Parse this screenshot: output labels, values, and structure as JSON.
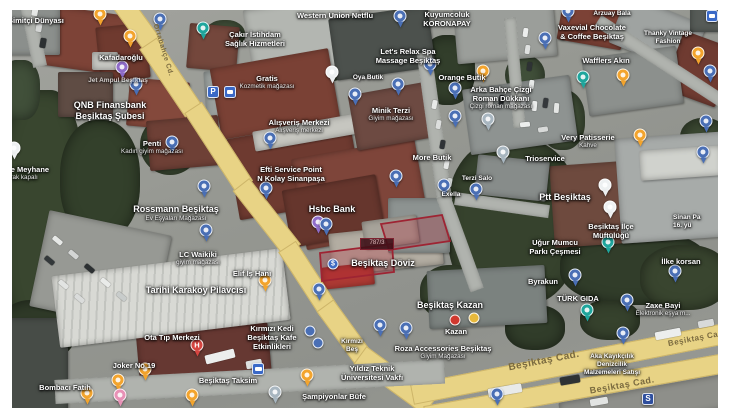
{
  "map": {
    "selected_parcel": {
      "badge": "787/3",
      "outline_color": "#9e2433",
      "fill_color": "rgba(178,34,52,0.28)"
    },
    "pin_colors": {
      "b": "#4a6fb5",
      "o": "#f3a42d",
      "t": "#1fa69d",
      "pu": "#8f6cc9",
      "h": "#d64540",
      "g": "#a8b6c0",
      "w": "#eef1f2",
      "pk": "#e891b6",
      "rc": "#d0382e",
      "yc": "#e8b93c",
      "bc": "#4a6fb5",
      "d": "#3f6bc4",
      "P": "#3a69c7",
      "S": "#2f4f9e",
      "BUS": "#3a69c7",
      "sq": "#3a69c7"
    },
    "road_labels": [
      {
        "text": "Ortabahçe Cd.",
        "x": 163,
        "y": 50,
        "rot": 73,
        "sz": 7
      },
      {
        "text": "Beşiktaş Cad.",
        "x": 697,
        "y": 338,
        "rot": -11,
        "sz": 8
      },
      {
        "text": "Beşiktaş Cad.",
        "x": 544,
        "y": 361,
        "rot": -11,
        "sz": 10
      },
      {
        "text": "Beşiktaş Cad.",
        "x": 622,
        "y": 385,
        "rot": -10,
        "sz": 9
      }
    ],
    "labels": [
      {
        "x": 8,
        "y": 16,
        "s": "m",
        "align": "l",
        "lines": [
          "Simitçi Dünyası"
        ]
      },
      {
        "x": 121,
        "y": 53,
        "s": "m",
        "lines": [
          "Kafadaroğlu"
        ]
      },
      {
        "x": 118,
        "y": 77,
        "s": "s",
        "dim": true,
        "lines": [
          "Jet Ampul Beşiktaş"
        ]
      },
      {
        "x": 110,
        "y": 100,
        "s": "l",
        "lines": [
          "QNB Finansbank",
          "Beşiktaş Şubesi"
        ]
      },
      {
        "x": 152,
        "y": 139,
        "s": "m",
        "lines": [
          "Penti"
        ],
        "sub": "Kadın giyim mağazası"
      },
      {
        "x": 2,
        "y": 165,
        "s": "m",
        "align": "l",
        "lines": [
          "ade Meyhane"
        ],
        "sub": "olarak kapalı"
      },
      {
        "x": 176,
        "y": 204,
        "s": "l",
        "lines": [
          "Rossmann Beşiktaş"
        ],
        "sub": "Ev Eşyaları Mağazası"
      },
      {
        "x": 198,
        "y": 250,
        "s": "m",
        "lines": [
          "LC Waikiki"
        ],
        "sub": "giyim mağazası"
      },
      {
        "x": 252,
        "y": 269,
        "s": "m",
        "lines": [
          "Elif İş Hanı"
        ]
      },
      {
        "x": 335,
        "y": 11,
        "s": "m",
        "lines": [
          "Western Union Netflu"
        ]
      },
      {
        "x": 447,
        "y": 10,
        "s": "m",
        "lines": [
          "Kuyumcoluk",
          "KORONAPAY"
        ]
      },
      {
        "x": 408,
        "y": 47,
        "s": "m",
        "lines": [
          "Let's Relax Spa",
          "Massage Beşiktaş"
        ]
      },
      {
        "x": 368,
        "y": 74,
        "s": "s",
        "lines": [
          "Oya Butik"
        ]
      },
      {
        "x": 462,
        "y": 73,
        "s": "m",
        "lines": [
          "Orange Butik"
        ]
      },
      {
        "x": 255,
        "y": 30,
        "s": "m",
        "lines": [
          "Çakır İstihdam",
          "Sağlık Hizmetleri"
        ]
      },
      {
        "x": 267,
        "y": 74,
        "s": "m",
        "lines": [
          "Gratis"
        ],
        "sub": "Kozmetik mağazası"
      },
      {
        "x": 299,
        "y": 118,
        "s": "m",
        "lines": [
          "Alışveriş Merkezi"
        ],
        "sub": "Alışveriş merkezi"
      },
      {
        "x": 391,
        "y": 106,
        "s": "m",
        "lines": [
          "Minik Terzi"
        ],
        "sub": "Giyim mağazası"
      },
      {
        "x": 291,
        "y": 165,
        "s": "m",
        "lines": [
          "Efti Service Point",
          "N Kolay Sinanpaşa"
        ]
      },
      {
        "x": 332,
        "y": 204,
        "s": "l",
        "lines": [
          "Hsbc Bank"
        ]
      },
      {
        "x": 432,
        "y": 153,
        "s": "m",
        "lines": [
          "More Butik"
        ]
      },
      {
        "x": 451,
        "y": 191,
        "s": "s",
        "lines": [
          "Exella"
        ]
      },
      {
        "x": 477,
        "y": 175,
        "s": "s",
        "lines": [
          "Terzi Salo"
        ]
      },
      {
        "x": 501,
        "y": 85,
        "s": "m",
        "lines": [
          "Arka Bahçe Çizgi",
          "Roman Dükkanı"
        ],
        "sub": "Çizgi roman mağazası"
      },
      {
        "x": 612,
        "y": 10,
        "s": "s",
        "lines": [
          "Arzuay Bala"
        ]
      },
      {
        "x": 592,
        "y": 23,
        "s": "m",
        "lines": [
          "Vaxevial Chocolate",
          "& Coffee Beşiktaş"
        ]
      },
      {
        "x": 668,
        "y": 30,
        "s": "s",
        "lines": [
          "Thanky Vintage",
          "Fashion"
        ]
      },
      {
        "x": 606,
        "y": 56,
        "s": "m",
        "lines": [
          "Wafflers Akın"
        ]
      },
      {
        "x": 588,
        "y": 133,
        "s": "m",
        "lines": [
          "Very Patisserie"
        ],
        "sub": "Kahve"
      },
      {
        "x": 545,
        "y": 154,
        "s": "m",
        "lines": [
          "Trioservice"
        ]
      },
      {
        "x": 565,
        "y": 192,
        "s": "l",
        "lines": [
          "Ptt Beşiktaş"
        ]
      },
      {
        "x": 611,
        "y": 222,
        "s": "m",
        "lines": [
          "Beşiktaş İlçe",
          "Müftülüğü"
        ]
      },
      {
        "x": 673,
        "y": 214,
        "s": "s",
        "align": "l",
        "lines": [
          "Sinan Pa",
          "16. yü"
        ]
      },
      {
        "x": 681,
        "y": 257,
        "s": "m",
        "lines": [
          "İlke korsan"
        ]
      },
      {
        "x": 555,
        "y": 238,
        "s": "m",
        "lines": [
          "Uğur Mumcu",
          "Parkı Çeşmesi"
        ]
      },
      {
        "x": 383,
        "y": 258,
        "s": "l",
        "lines": [
          "Beşiktaş Döviz"
        ]
      },
      {
        "x": 578,
        "y": 294,
        "s": "m",
        "lines": [
          "TÜRK GIDA"
        ]
      },
      {
        "x": 543,
        "y": 277,
        "s": "m",
        "lines": [
          "Byrakun"
        ]
      },
      {
        "x": 663,
        "y": 301,
        "s": "m",
        "lines": [
          "Zaxe Bayi"
        ],
        "sub": "Elektronik eşya m..."
      },
      {
        "x": 450,
        "y": 300,
        "s": "l",
        "lines": [
          "Beşiktaş Kazan"
        ]
      },
      {
        "x": 456,
        "y": 327,
        "s": "m",
        "lines": [
          "Kazan"
        ]
      },
      {
        "x": 443,
        "y": 344,
        "s": "m",
        "lines": [
          "Roza Accessories Beşiktaş"
        ],
        "sub": "Giyim Mağazası"
      },
      {
        "x": 372,
        "y": 364,
        "s": "m",
        "lines": [
          "Yıldız Teknik",
          "Üniversitesi Vakfı"
        ]
      },
      {
        "x": 334,
        "y": 392,
        "s": "m",
        "lines": [
          "Şampiyonlar Büfe"
        ]
      },
      {
        "x": 228,
        "y": 376,
        "s": "m",
        "lines": [
          "Beşiktaş Taksim"
        ]
      },
      {
        "x": 196,
        "y": 285,
        "s": "l",
        "lines": [
          "Tarihi Karaköy Pilavcısı"
        ]
      },
      {
        "x": 172,
        "y": 333,
        "s": "m",
        "lines": [
          "Ota Tıp Merkezi"
        ]
      },
      {
        "x": 134,
        "y": 361,
        "s": "m",
        "lines": [
          "Joker No 19"
        ]
      },
      {
        "x": 65,
        "y": 383,
        "s": "m",
        "lines": [
          "Bombacı Fatih"
        ]
      },
      {
        "x": 272,
        "y": 324,
        "s": "m",
        "lines": [
          "Kırmızı Kedi",
          "Beşiktaş Kafe",
          "Etkinlikleri"
        ]
      },
      {
        "x": 352,
        "y": 338,
        "s": "s",
        "lines": [
          "Kırmızı",
          "Beş"
        ]
      },
      {
        "x": 612,
        "y": 353,
        "s": "s",
        "lines": [
          "Aka Kayıkçılık",
          "Denizcilik",
          "Malzemeleri Satışı"
        ]
      }
    ],
    "pins": [
      {
        "t": "o",
        "x": 100,
        "y": 18
      },
      {
        "t": "o",
        "x": 130,
        "y": 40
      },
      {
        "t": "t",
        "x": 203,
        "y": 32
      },
      {
        "t": "b",
        "x": 160,
        "y": 23
      },
      {
        "t": "b",
        "x": 400,
        "y": 20
      },
      {
        "t": "b",
        "x": 568,
        "y": 15
      },
      {
        "t": "sq",
        "x": 712,
        "y": 16
      },
      {
        "t": "o",
        "x": 698,
        "y": 57
      },
      {
        "t": "b",
        "x": 430,
        "y": 68
      },
      {
        "t": "b",
        "x": 545,
        "y": 42
      },
      {
        "t": "w",
        "x": 332,
        "y": 76
      },
      {
        "t": "b",
        "x": 455,
        "y": 92
      },
      {
        "t": "o",
        "x": 483,
        "y": 75
      },
      {
        "t": "b",
        "x": 398,
        "y": 88
      },
      {
        "t": "pu",
        "x": 122,
        "y": 71
      },
      {
        "t": "b",
        "x": 136,
        "y": 88
      },
      {
        "t": "P",
        "x": 213,
        "y": 92
      },
      {
        "t": "sq",
        "x": 230,
        "y": 92
      },
      {
        "t": "b",
        "x": 355,
        "y": 98
      },
      {
        "t": "b",
        "x": 455,
        "y": 120
      },
      {
        "t": "g",
        "x": 488,
        "y": 123
      },
      {
        "t": "o",
        "x": 623,
        "y": 79
      },
      {
        "t": "b",
        "x": 270,
        "y": 142
      },
      {
        "t": "g",
        "x": 503,
        "y": 156
      },
      {
        "t": "o",
        "x": 640,
        "y": 139
      },
      {
        "t": "t",
        "x": 583,
        "y": 81
      },
      {
        "t": "b",
        "x": 266,
        "y": 192
      },
      {
        "t": "b",
        "x": 396,
        "y": 180
      },
      {
        "t": "pu",
        "x": 318,
        "y": 226
      },
      {
        "t": "b",
        "x": 476,
        "y": 193
      },
      {
        "t": "b",
        "x": 444,
        "y": 189
      },
      {
        "t": "b",
        "x": 326,
        "y": 228
      },
      {
        "t": "d",
        "x": 333,
        "y": 264
      },
      {
        "t": "b",
        "x": 319,
        "y": 293
      },
      {
        "t": "t",
        "x": 608,
        "y": 246
      },
      {
        "t": "w",
        "x": 605,
        "y": 189
      },
      {
        "t": "w",
        "x": 610,
        "y": 211
      },
      {
        "t": "b",
        "x": 703,
        "y": 156
      },
      {
        "t": "b",
        "x": 675,
        "y": 275
      },
      {
        "t": "b",
        "x": 575,
        "y": 279
      },
      {
        "t": "h",
        "x": 197,
        "y": 349
      },
      {
        "t": "o",
        "x": 265,
        "y": 284
      },
      {
        "t": "bc",
        "x": 310,
        "y": 331
      },
      {
        "t": "bc",
        "x": 318,
        "y": 343
      },
      {
        "t": "b",
        "x": 380,
        "y": 329
      },
      {
        "t": "BUS",
        "x": 258,
        "y": 369
      },
      {
        "t": "o",
        "x": 145,
        "y": 373
      },
      {
        "t": "o",
        "x": 118,
        "y": 384
      },
      {
        "t": "o",
        "x": 87,
        "y": 397
      },
      {
        "t": "pk",
        "x": 120,
        "y": 399
      },
      {
        "t": "o",
        "x": 192,
        "y": 399
      },
      {
        "t": "g",
        "x": 275,
        "y": 396
      },
      {
        "t": "o",
        "x": 307,
        "y": 379
      },
      {
        "t": "rc",
        "x": 455,
        "y": 320
      },
      {
        "t": "yc",
        "x": 474,
        "y": 318
      },
      {
        "t": "b",
        "x": 406,
        "y": 332
      },
      {
        "t": "b",
        "x": 623,
        "y": 337
      },
      {
        "t": "b",
        "x": 497,
        "y": 398
      },
      {
        "t": "S",
        "x": 648,
        "y": 399
      },
      {
        "t": "t",
        "x": 587,
        "y": 314
      },
      {
        "t": "b",
        "x": 627,
        "y": 304
      },
      {
        "t": "b",
        "x": 706,
        "y": 125
      },
      {
        "t": "b",
        "x": 710,
        "y": 75
      },
      {
        "t": "w",
        "x": 14,
        "y": 152
      },
      {
        "t": "b",
        "x": 172,
        "y": 146
      },
      {
        "t": "b",
        "x": 204,
        "y": 190
      },
      {
        "t": "b",
        "x": 206,
        "y": 234
      }
    ]
  }
}
